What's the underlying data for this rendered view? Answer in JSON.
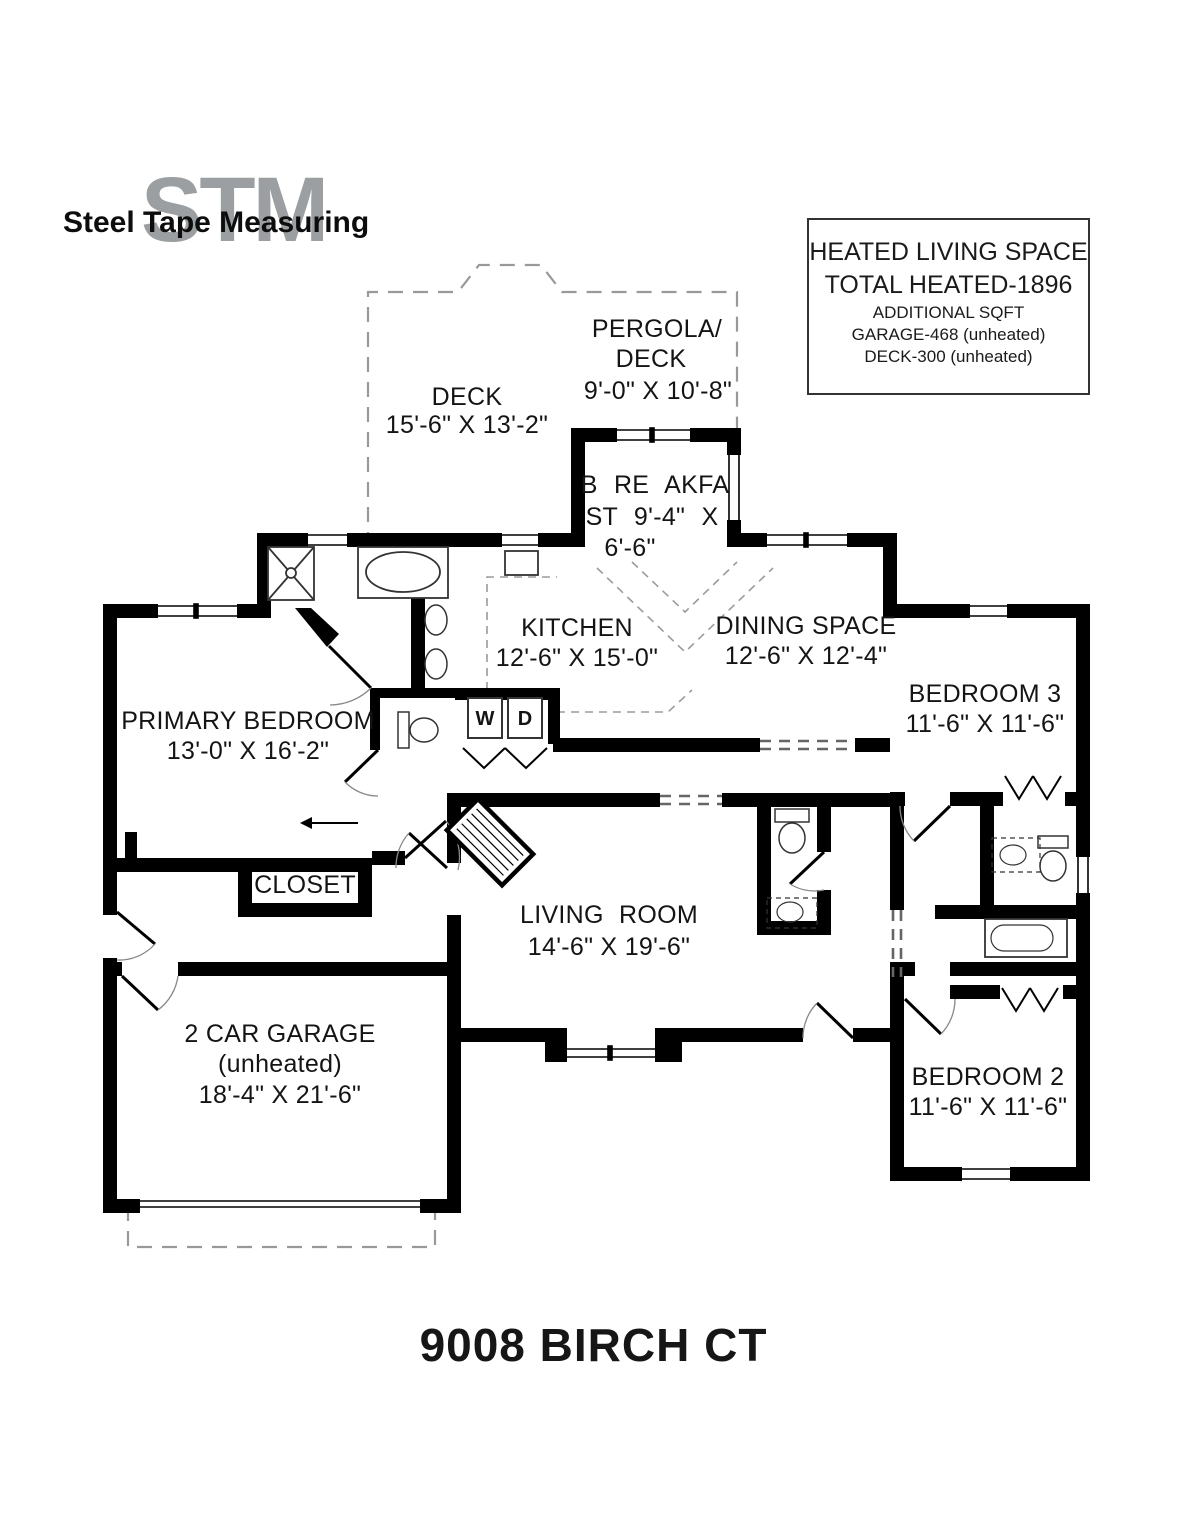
{
  "logo": {
    "monogram": "STM",
    "text": "Steel Tape Measuring"
  },
  "info_box": {
    "line1": "HEATED LIVING SPACE",
    "line2": "TOTAL HEATED-1896",
    "line3": "ADDITIONAL SQFT",
    "line4": "GARAGE-468 (unheated)",
    "line5": "DECK-300 (unheated)"
  },
  "rooms": {
    "deck": {
      "name": "DECK",
      "dims": "15'-6\" X 13'-2\""
    },
    "pergola": {
      "line1": "PERGOLA/",
      "line2": "DECK",
      "dims": "9'-0\" X 10'-8\""
    },
    "breakfast": {
      "line1": "B RE AKFA",
      "line2": "ST 9'-4\" X",
      "line3": "6'-6\""
    },
    "kitchen": {
      "name": "KITCHEN",
      "dims": "12'-6\" X 15'-0\""
    },
    "dining": {
      "name": "DINING SPACE",
      "dims": "12'-6\" X 12'-4\""
    },
    "bedroom3": {
      "name": "BEDROOM 3",
      "dims": "11'-6\" X 11'-6\""
    },
    "primary": {
      "name": "PRIMARY BEDROOM",
      "dims": "13'-0\" X 16'-2\""
    },
    "closet": {
      "name": "CLOSET"
    },
    "living": {
      "name": "LIVING ROOM",
      "dims": "14'-6\" X 19'-6\""
    },
    "garage": {
      "name": "2 CAR GARAGE",
      "sub": "(unheated)",
      "dims": "18'-4\" X 21'-6\""
    },
    "bedroom2": {
      "name": "BEDROOM 2",
      "dims": "11'-6\" X 11'-6\""
    }
  },
  "fixtures": {
    "washer": "W",
    "dryer": "D"
  },
  "title": "9008 BIRCH CT",
  "colors": {
    "wall": "#000000",
    "dashed_gray": "#999999",
    "logo_gray": "#9b9fa1",
    "text": "#141414"
  }
}
